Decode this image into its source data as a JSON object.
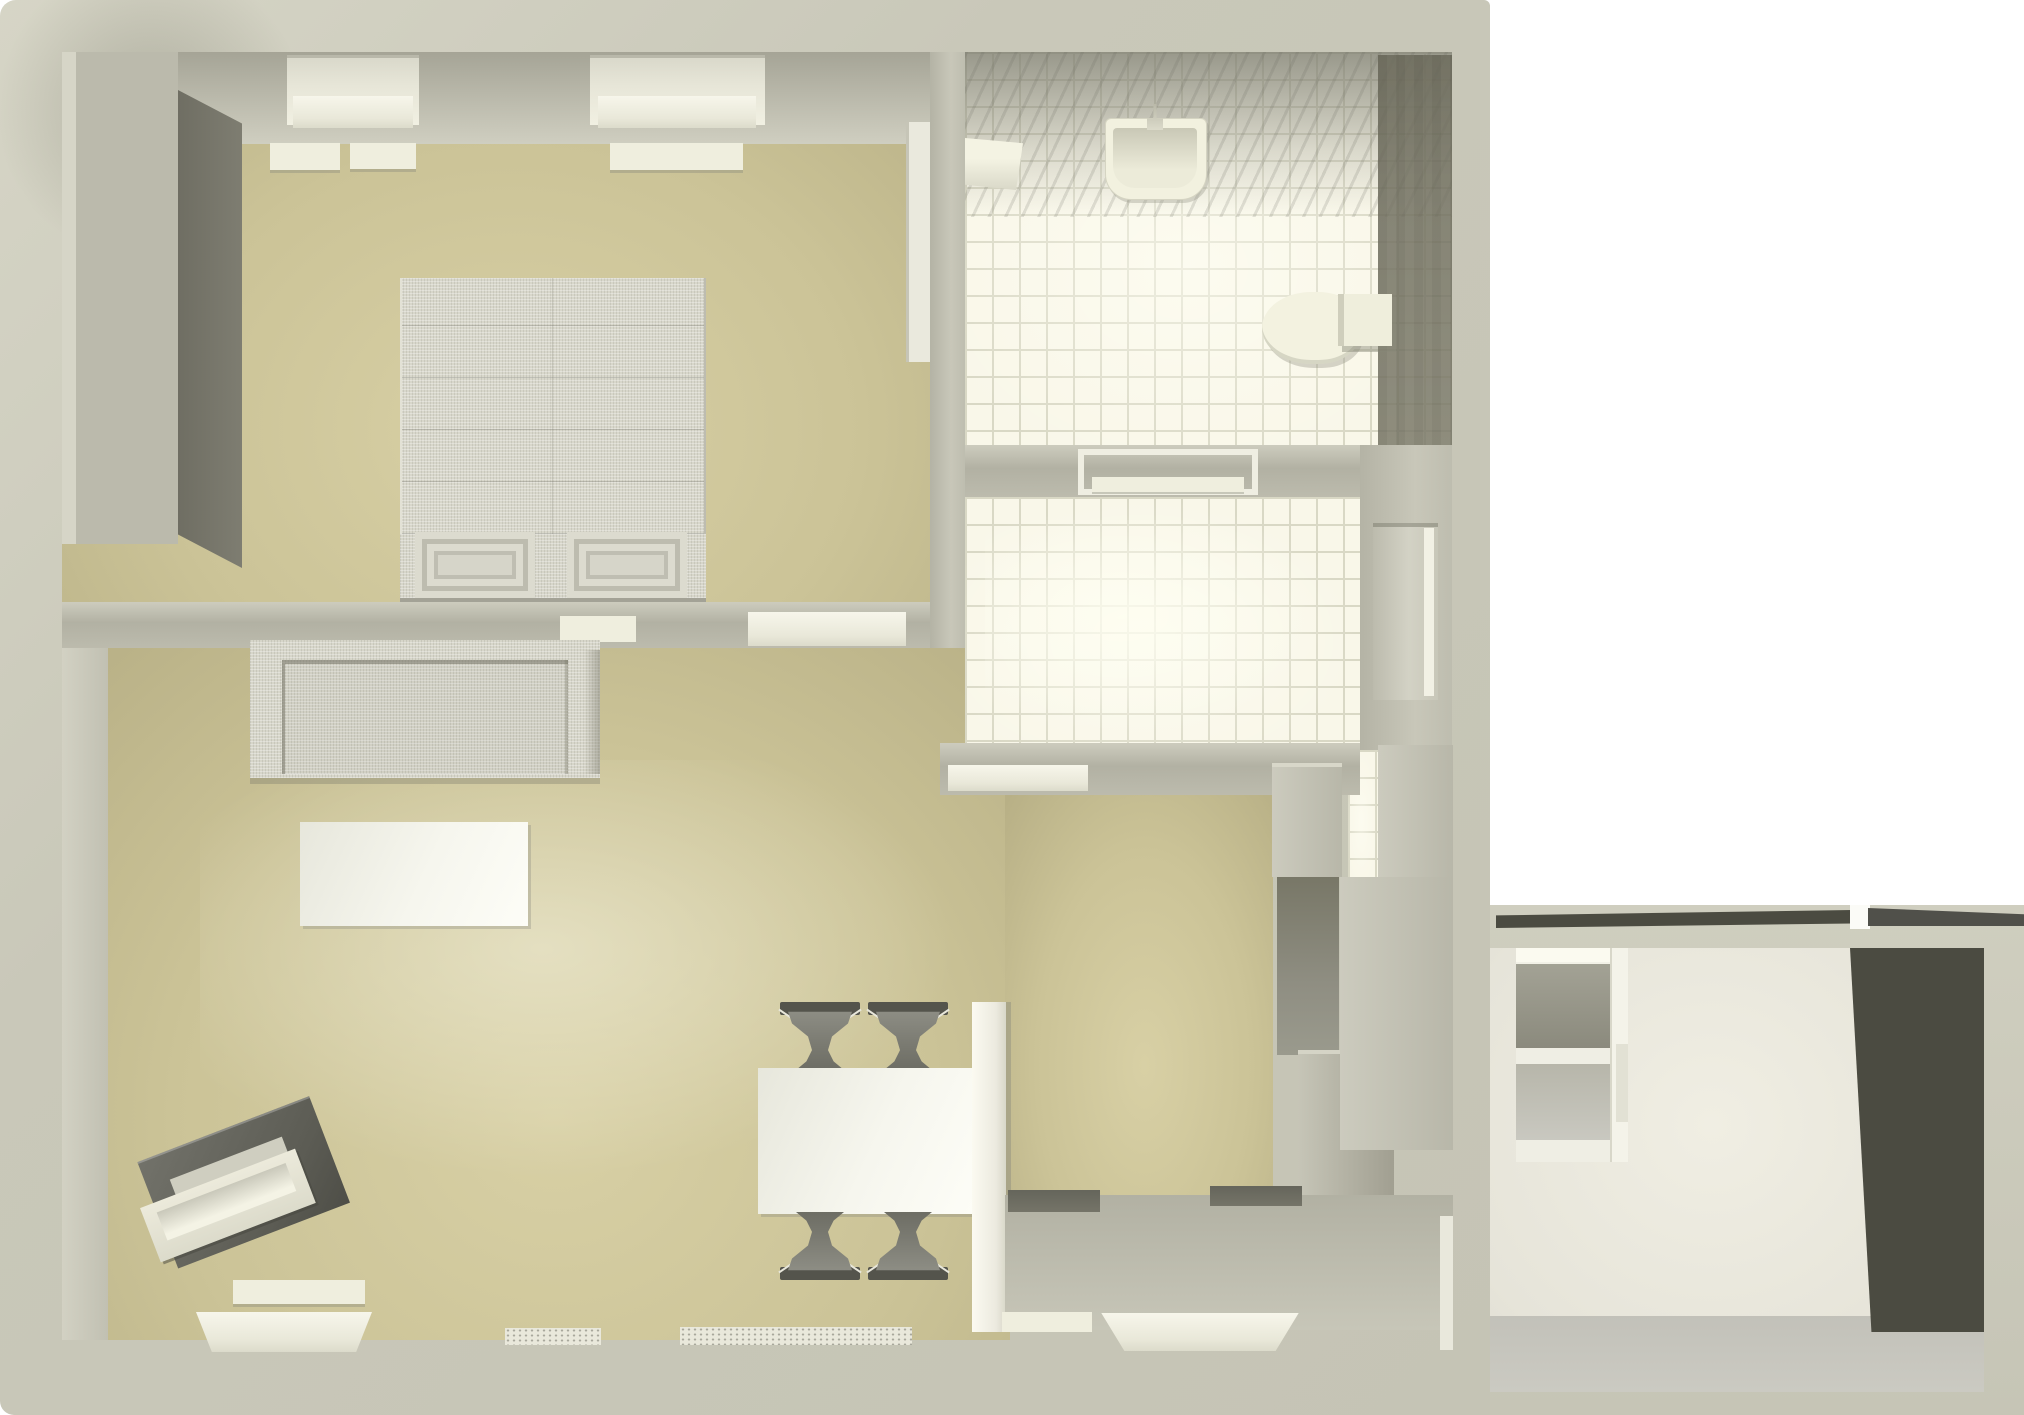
{
  "scene": {
    "type": "3d-floor-plan-render",
    "view": "top-down-birds-eye",
    "description": "Rendered top view of an apartment: bedroom top-left, tiled bathroom top-right, tiled hallway middle-right, open living/dining room bottom-left, kitchen bottom-right, and a separate annex room at far right.",
    "visible_text": "none"
  },
  "palette": {
    "outer_wall_band": "#c9c8b9",
    "floor_khaki": "#cbc397",
    "tile_base": "#f9f7e9",
    "tile_grout": "#d9d8c5",
    "interior_wall_shadow": "#a5a496",
    "cream_fixture": "#efeede",
    "furniture_fabric": "#d7d6ca",
    "chair_dark": "#7a7a71",
    "piano_dark": "#63635a",
    "annex_dark_panel": "#4b4b41",
    "background": "#ffffff"
  },
  "rooms": [
    {
      "id": "bedroom",
      "position": "top-left",
      "floor": "khaki",
      "furniture": [
        "wardrobe",
        "double-bed",
        "pillow",
        "pillow",
        "window",
        "window",
        "radiator-bar",
        "ceiling-light-bar",
        "door-panel"
      ]
    },
    {
      "id": "bathroom",
      "position": "top-right",
      "floor": "white-tiles",
      "furniture": [
        "wall-shelf",
        "sink-with-faucet",
        "toilet-with-tank",
        "shadow-striped-wall"
      ]
    },
    {
      "id": "hallway",
      "position": "middle-right",
      "floor": "white-tiles",
      "furniture": [
        "open-door-frame",
        "recessed-door-niche",
        "tile-passage-strip"
      ]
    },
    {
      "id": "living-room",
      "position": "bottom-left",
      "floor": "khaki",
      "furniture": [
        "sofa",
        "coffee-table",
        "keyboard-piano",
        "dining-table",
        "chair",
        "chair",
        "chair",
        "chair",
        "partition-wall",
        "radiator-bar",
        "window-sill",
        "threshold",
        "threshold"
      ]
    },
    {
      "id": "kitchen",
      "position": "bottom-right",
      "floor": "khaki-and-grey",
      "furniture": [
        "counter-column",
        "counter-shadow-face",
        "fridge-block",
        "tall-cabinet",
        "dark-counter",
        "dark-counter",
        "window-sill-small",
        "window-sill-large"
      ]
    },
    {
      "id": "annex-room",
      "position": "far-right",
      "floor": "grey",
      "furniture": [
        "shelf-unit",
        "dark-wall-panel",
        "roof-edge-wedges"
      ]
    }
  ],
  "counts": {
    "chairs": 4,
    "windows_bedroom": 2,
    "tiled_rooms": 2
  },
  "labels": {
    "bed": "double bed with two pillows",
    "sofa": "three-seat fabric sofa",
    "piano": "electric keyboard, rotated",
    "dining": "white dining table with four dark chairs",
    "toilet": "toilet with cistern",
    "sink": "wall-mounted washbasin"
  }
}
